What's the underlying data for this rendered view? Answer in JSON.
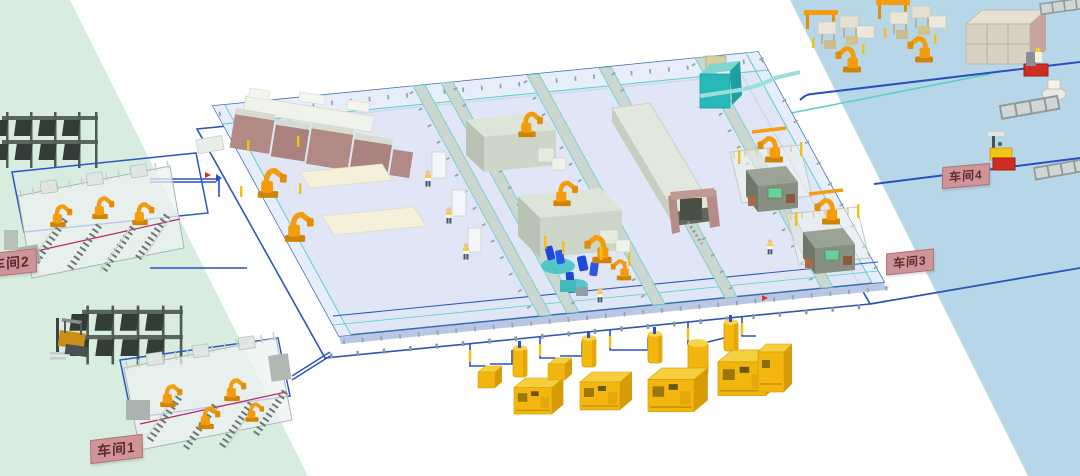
{
  "workshops": [
    {
      "id": "workshop-1",
      "label": "车间1"
    },
    {
      "id": "workshop-2",
      "label": "车间2"
    },
    {
      "id": "workshop-3",
      "label": "车间3"
    },
    {
      "id": "workshop-4",
      "label": "车间4"
    }
  ],
  "colors": {
    "band_green": "#d8ecdf",
    "band_white": "#ffffff",
    "band_blue": "#b7d7e8",
    "floor_fill": "#dde4f4",
    "floor_outline_blue": "#2d55b8",
    "walkway_fill": "#e7edf9",
    "conveyor_teal": "#5bd0c7",
    "robot_orange": "#f59c0c",
    "press_mauve": "#b18a85",
    "machine_gray_green": "#cdd6c8",
    "compressor_yellow": "#f2b80e",
    "pipe_blue": "#2b50cc",
    "seat_blue": "#1f48d8",
    "rack_dark": "#49554d",
    "cart_red": "#cf2d20",
    "paint_booth_teal": "#27b9b9",
    "label_bg": "#cf9498",
    "label_text": "#5e2a2f",
    "weld_line_magenta": "#c2246a"
  }
}
